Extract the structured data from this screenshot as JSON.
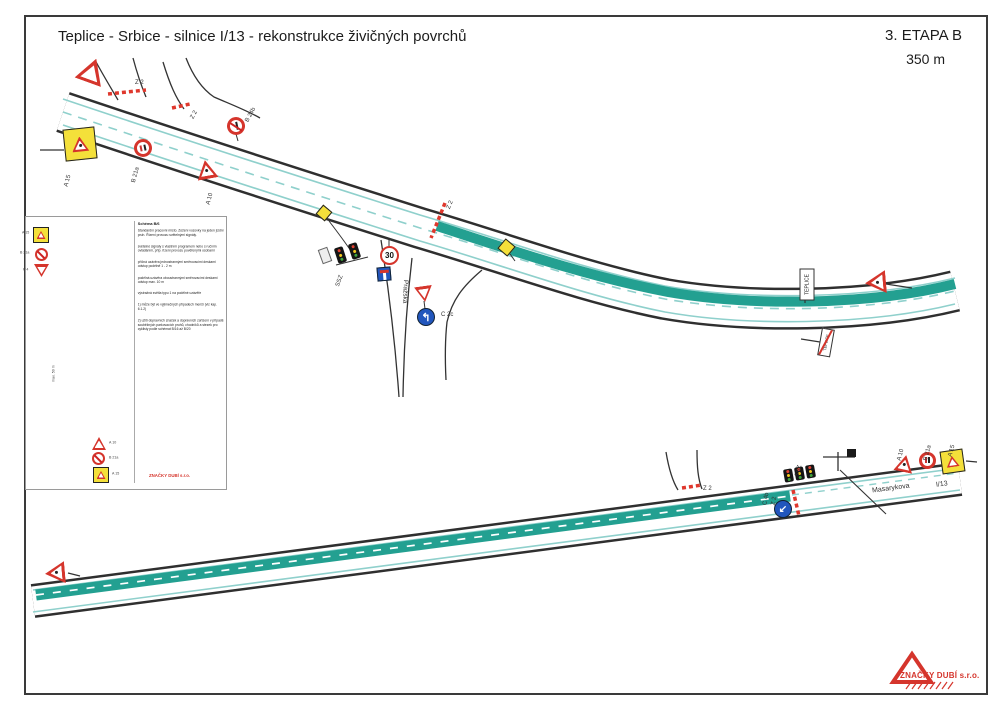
{
  "header": {
    "title": "Teplice - Srbice - silnice I/13 - rekonstrukce živičných povrchů",
    "stage": "3. ETAPA B",
    "distance": "350 m"
  },
  "company": {
    "name": "ZNAČKY DUBÍ s.r.o."
  },
  "colors": {
    "work_zone_teal": "#23a091",
    "legend_zone_green": "#17a356",
    "sign_red": "#d5352c",
    "sign_yellow": "#f4e03a",
    "sign_blue": "#2156bd",
    "lane_line_cyan": "#8fd0cc"
  },
  "legend": {
    "heading": "Schéma B/6",
    "intro": "Standardní pracovní místo. Zúžení vozovky na jeden jízdní pruh. Řízení provozu světelnými signály.",
    "notes": [
      "světelné signály s vlastním programem nebo s ručním ovládáním, příp. řízení provozu pověřenými osobami",
      "příčná uzávěra jednostrannými směrovacími deskami odstup podélně 1 - 2 m",
      "podélná uzávěra oboustrannými směrovacími deskami odstup max. 10 m",
      "výstražná světla typu 1 na podélné uzávěře"
    ],
    "footnotes": [
      "1) může být ve výjimečných případech menší (viz kap. 6.1.2)",
      "2) užití dopravních značek a dopravních zařízení v případě souběžných parkovacích pruhů, chodníků a stezek pro cyklisty podle schémat B/16 až B/20"
    ],
    "distance_note": "max. 50 m",
    "left_signs": [
      {
        "label": "A 15"
      },
      {
        "label": "B 21a"
      },
      {
        "label": "P 4"
      }
    ],
    "right_signs": [
      {
        "label": "A 10"
      },
      {
        "label": "B 21a"
      },
      {
        "label": "A 15"
      }
    ]
  },
  "top_road": {
    "labels": {
      "z2_a": "Z 2",
      "z2_b": "Z 2",
      "z2_c": "Z 2",
      "a15": "A 15",
      "b21a": "B 21a",
      "a10": "A 10",
      "b24b": "B 24b",
      "ssz": "SSZ",
      "speed": "30",
      "c2c": "C 2c",
      "street": "Pražská",
      "direction": "TEPLICE",
      "direction_end": "TEPLICE"
    }
  },
  "bottom_road": {
    "labels": {
      "z2_junction": "Z 2",
      "c4b": "C 4b",
      "z2_sign": "Z 2",
      "ssz": "SSZ",
      "a10": "A 10",
      "b21a": "B 21a",
      "a15": "A 15",
      "street": "Masarykova",
      "route": "I/13"
    }
  }
}
